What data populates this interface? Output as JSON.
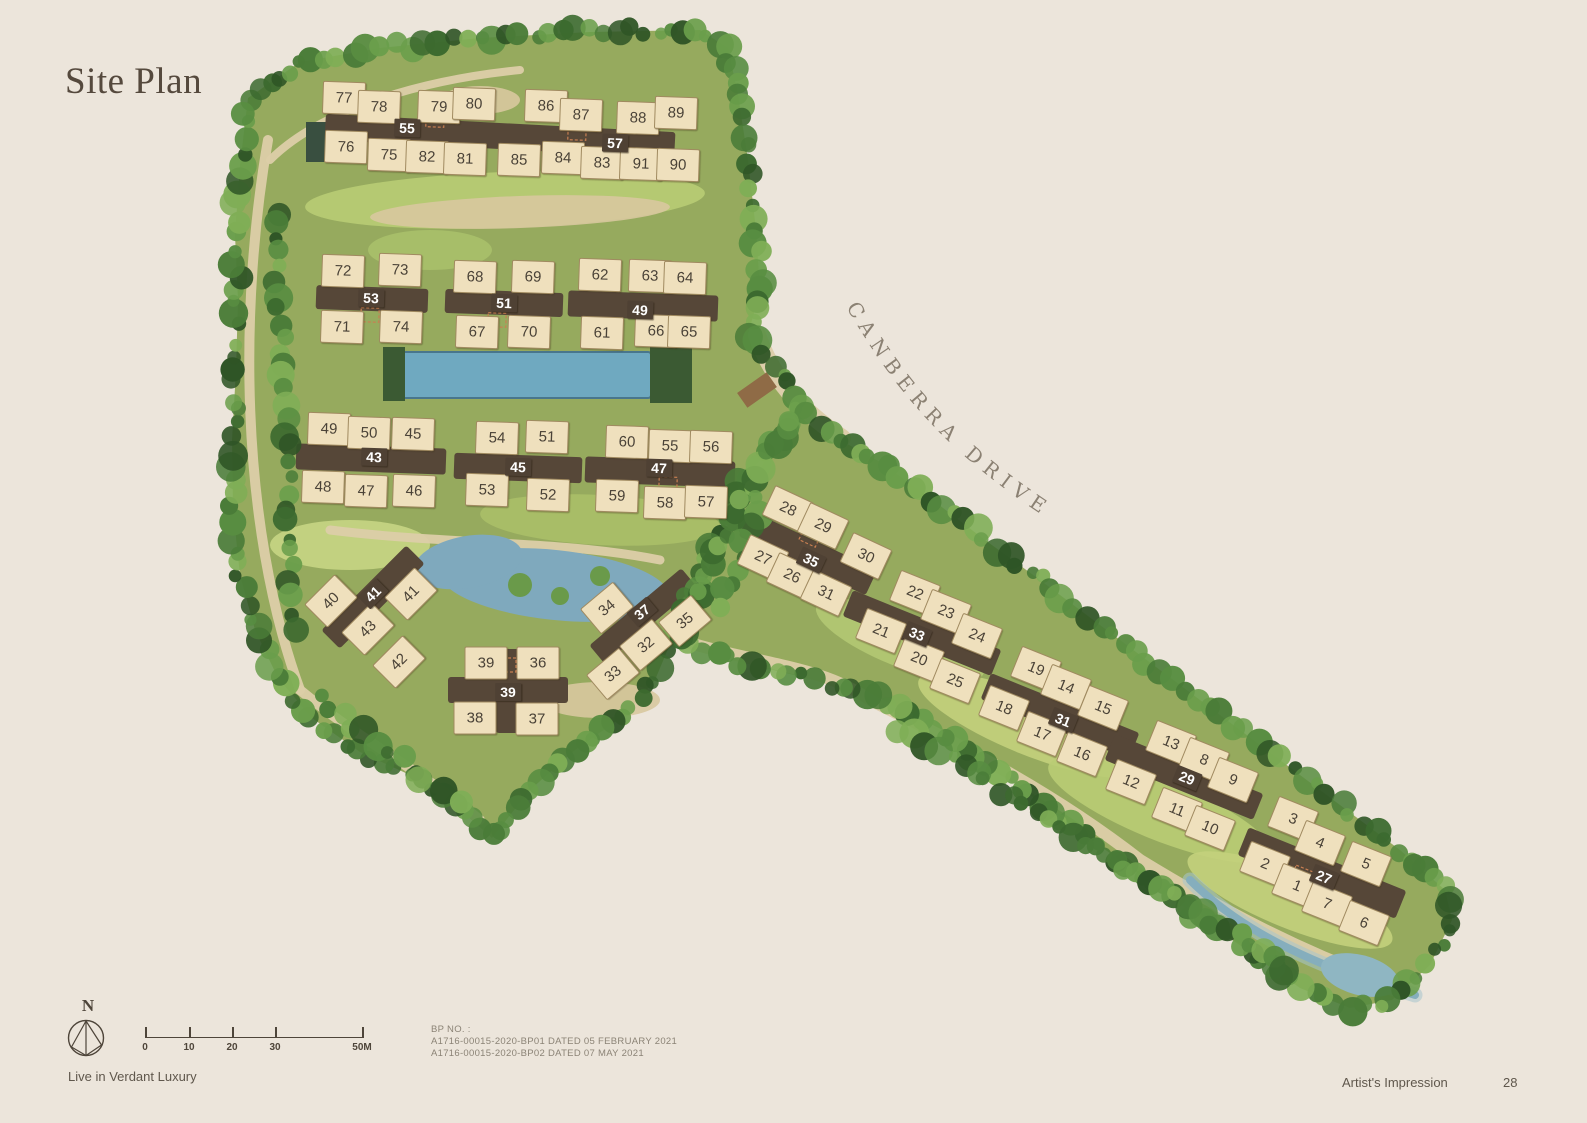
{
  "page": {
    "title": "Site Plan"
  },
  "road": {
    "name": "CANBERRA DRIVE"
  },
  "compass": {
    "label": "N"
  },
  "scale_bar": {
    "ticks": [
      "0",
      "10",
      "20",
      "30",
      "50M"
    ]
  },
  "bp_note": {
    "heading": "BP NO. :",
    "lines": [
      "A1716-00015-2020-BP01 DATED 05 FEBRUARY 2021",
      "A1716-00015-2020-BP02 DATED 07 MAY 2021"
    ]
  },
  "footer": {
    "left": "Live in Verdant Luxury",
    "right": "Artist's Impression",
    "page_number": "28"
  },
  "site": {
    "blocks": [
      {
        "n": "55",
        "x": 407,
        "y": 128,
        "r": 2
      },
      {
        "n": "57",
        "x": 615,
        "y": 143,
        "r": 2
      },
      {
        "n": "53",
        "x": 371,
        "y": 298,
        "r": 2
      },
      {
        "n": "51",
        "x": 504,
        "y": 303,
        "r": 2
      },
      {
        "n": "49",
        "x": 640,
        "y": 310,
        "r": 2
      },
      {
        "n": "43",
        "x": 374,
        "y": 457,
        "r": 2
      },
      {
        "n": "45",
        "x": 518,
        "y": 467,
        "r": 2
      },
      {
        "n": "47",
        "x": 659,
        "y": 468,
        "r": 2
      },
      {
        "n": "41",
        "x": 373,
        "y": 594,
        "r": -45
      },
      {
        "n": "37",
        "x": 642,
        "y": 612,
        "r": -40
      },
      {
        "n": "39",
        "x": 508,
        "y": 692,
        "r": 0
      },
      {
        "n": "35",
        "x": 811,
        "y": 560,
        "r": 25
      },
      {
        "n": "33",
        "x": 917,
        "y": 634,
        "r": 22
      },
      {
        "n": "31",
        "x": 1063,
        "y": 720,
        "r": 22
      },
      {
        "n": "29",
        "x": 1187,
        "y": 778,
        "r": 22
      },
      {
        "n": "27",
        "x": 1324,
        "y": 877,
        "r": 22
      }
    ],
    "units": [
      {
        "n": "77",
        "x": 344,
        "y": 98,
        "r": 2
      },
      {
        "n": "78",
        "x": 379,
        "y": 107,
        "r": 2
      },
      {
        "n": "79",
        "x": 439,
        "y": 107,
        "r": 2
      },
      {
        "n": "80",
        "x": 474,
        "y": 104,
        "r": 2
      },
      {
        "n": "86",
        "x": 546,
        "y": 106,
        "r": 2
      },
      {
        "n": "87",
        "x": 581,
        "y": 115,
        "r": 2
      },
      {
        "n": "88",
        "x": 638,
        "y": 118,
        "r": 2
      },
      {
        "n": "89",
        "x": 676,
        "y": 113,
        "r": 2
      },
      {
        "n": "76",
        "x": 346,
        "y": 147,
        "r": 2
      },
      {
        "n": "75",
        "x": 389,
        "y": 155,
        "r": 2
      },
      {
        "n": "82",
        "x": 427,
        "y": 157,
        "r": 2
      },
      {
        "n": "81",
        "x": 465,
        "y": 159,
        "r": 2
      },
      {
        "n": "85",
        "x": 519,
        "y": 160,
        "r": 2
      },
      {
        "n": "84",
        "x": 563,
        "y": 158,
        "r": 2
      },
      {
        "n": "83",
        "x": 602,
        "y": 163,
        "r": 2
      },
      {
        "n": "91",
        "x": 641,
        "y": 164,
        "r": 2
      },
      {
        "n": "90",
        "x": 678,
        "y": 165,
        "r": 2
      },
      {
        "n": "72",
        "x": 343,
        "y": 271,
        "r": 2
      },
      {
        "n": "73",
        "x": 400,
        "y": 270,
        "r": 2
      },
      {
        "n": "71",
        "x": 342,
        "y": 327,
        "r": 2
      },
      {
        "n": "74",
        "x": 401,
        "y": 327,
        "r": 2
      },
      {
        "n": "68",
        "x": 475,
        "y": 277,
        "r": 2
      },
      {
        "n": "69",
        "x": 533,
        "y": 277,
        "r": 2
      },
      {
        "n": "67",
        "x": 477,
        "y": 332,
        "r": 2
      },
      {
        "n": "70",
        "x": 529,
        "y": 332,
        "r": 2
      },
      {
        "n": "62",
        "x": 600,
        "y": 275,
        "r": 2
      },
      {
        "n": "63",
        "x": 650,
        "y": 276,
        "r": 2
      },
      {
        "n": "64",
        "x": 685,
        "y": 278,
        "r": 2
      },
      {
        "n": "61",
        "x": 602,
        "y": 333,
        "r": 2
      },
      {
        "n": "66",
        "x": 656,
        "y": 331,
        "r": 2
      },
      {
        "n": "65",
        "x": 689,
        "y": 332,
        "r": 2
      },
      {
        "n": "49",
        "x": 329,
        "y": 429,
        "r": 2
      },
      {
        "n": "50",
        "x": 369,
        "y": 433,
        "r": 2
      },
      {
        "n": "45",
        "x": 413,
        "y": 434,
        "r": 2
      },
      {
        "n": "48",
        "x": 323,
        "y": 487,
        "r": 2
      },
      {
        "n": "47",
        "x": 366,
        "y": 491,
        "r": 2
      },
      {
        "n": "46",
        "x": 414,
        "y": 491,
        "r": 2
      },
      {
        "n": "54",
        "x": 497,
        "y": 438,
        "r": 2
      },
      {
        "n": "51",
        "x": 547,
        "y": 437,
        "r": 2
      },
      {
        "n": "53",
        "x": 487,
        "y": 490,
        "r": 2
      },
      {
        "n": "52",
        "x": 548,
        "y": 495,
        "r": 2
      },
      {
        "n": "60",
        "x": 627,
        "y": 442,
        "r": 2
      },
      {
        "n": "55",
        "x": 670,
        "y": 446,
        "r": 2
      },
      {
        "n": "56",
        "x": 711,
        "y": 447,
        "r": 2
      },
      {
        "n": "59",
        "x": 617,
        "y": 496,
        "r": 2
      },
      {
        "n": "58",
        "x": 665,
        "y": 503,
        "r": 2
      },
      {
        "n": "57",
        "x": 706,
        "y": 502,
        "r": 2
      },
      {
        "n": "40",
        "x": 331,
        "y": 601,
        "r": -45
      },
      {
        "n": "41",
        "x": 411,
        "y": 594,
        "r": -45
      },
      {
        "n": "43",
        "x": 368,
        "y": 629,
        "r": -45
      },
      {
        "n": "42",
        "x": 399,
        "y": 662,
        "r": -45
      },
      {
        "n": "34",
        "x": 607,
        "y": 608,
        "r": -40
      },
      {
        "n": "35",
        "x": 685,
        "y": 621,
        "r": -40
      },
      {
        "n": "32",
        "x": 646,
        "y": 645,
        "r": -40
      },
      {
        "n": "33",
        "x": 613,
        "y": 674,
        "r": -40
      },
      {
        "n": "39",
        "x": 486,
        "y": 663,
        "r": 0
      },
      {
        "n": "36",
        "x": 538,
        "y": 663,
        "r": 0
      },
      {
        "n": "38",
        "x": 475,
        "y": 718,
        "r": 0
      },
      {
        "n": "37",
        "x": 537,
        "y": 719,
        "r": 0
      },
      {
        "n": "28",
        "x": 788,
        "y": 509,
        "r": 25
      },
      {
        "n": "29",
        "x": 823,
        "y": 526,
        "r": 25
      },
      {
        "n": "30",
        "x": 866,
        "y": 556,
        "r": 25
      },
      {
        "n": "27",
        "x": 763,
        "y": 558,
        "r": 25
      },
      {
        "n": "26",
        "x": 792,
        "y": 576,
        "r": 25
      },
      {
        "n": "31",
        "x": 826,
        "y": 593,
        "r": 25
      },
      {
        "n": "22",
        "x": 915,
        "y": 593,
        "r": 22
      },
      {
        "n": "23",
        "x": 946,
        "y": 612,
        "r": 22
      },
      {
        "n": "21",
        "x": 881,
        "y": 631,
        "r": 22
      },
      {
        "n": "24",
        "x": 977,
        "y": 636,
        "r": 22
      },
      {
        "n": "20",
        "x": 919,
        "y": 659,
        "r": 22
      },
      {
        "n": "25",
        "x": 955,
        "y": 681,
        "r": 22
      },
      {
        "n": "19",
        "x": 1036,
        "y": 669,
        "r": 22
      },
      {
        "n": "14",
        "x": 1066,
        "y": 687,
        "r": 22
      },
      {
        "n": "18",
        "x": 1004,
        "y": 708,
        "r": 22
      },
      {
        "n": "15",
        "x": 1103,
        "y": 708,
        "r": 22
      },
      {
        "n": "17",
        "x": 1042,
        "y": 734,
        "r": 22
      },
      {
        "n": "16",
        "x": 1082,
        "y": 754,
        "r": 22
      },
      {
        "n": "13",
        "x": 1171,
        "y": 743,
        "r": 22
      },
      {
        "n": "8",
        "x": 1204,
        "y": 760,
        "r": 22
      },
      {
        "n": "9",
        "x": 1233,
        "y": 780,
        "r": 22
      },
      {
        "n": "12",
        "x": 1131,
        "y": 782,
        "r": 22
      },
      {
        "n": "11",
        "x": 1177,
        "y": 810,
        "r": 22
      },
      {
        "n": "10",
        "x": 1210,
        "y": 828,
        "r": 22
      },
      {
        "n": "3",
        "x": 1293,
        "y": 819,
        "r": 22
      },
      {
        "n": "4",
        "x": 1320,
        "y": 843,
        "r": 22
      },
      {
        "n": "2",
        "x": 1265,
        "y": 864,
        "r": 22
      },
      {
        "n": "5",
        "x": 1366,
        "y": 864,
        "r": 22
      },
      {
        "n": "1",
        "x": 1297,
        "y": 886,
        "r": 22
      },
      {
        "n": "7",
        "x": 1327,
        "y": 904,
        "r": 22
      },
      {
        "n": "6",
        "x": 1364,
        "y": 923,
        "r": 22
      }
    ]
  },
  "colors": {
    "background": "#ece5db",
    "unit_fill": "#efe0bd",
    "core_brown": "#4f4134",
    "tree_dark": "#3c6a2f",
    "pool_blue": "#6fa9c0",
    "road_text": "#8b8173"
  }
}
